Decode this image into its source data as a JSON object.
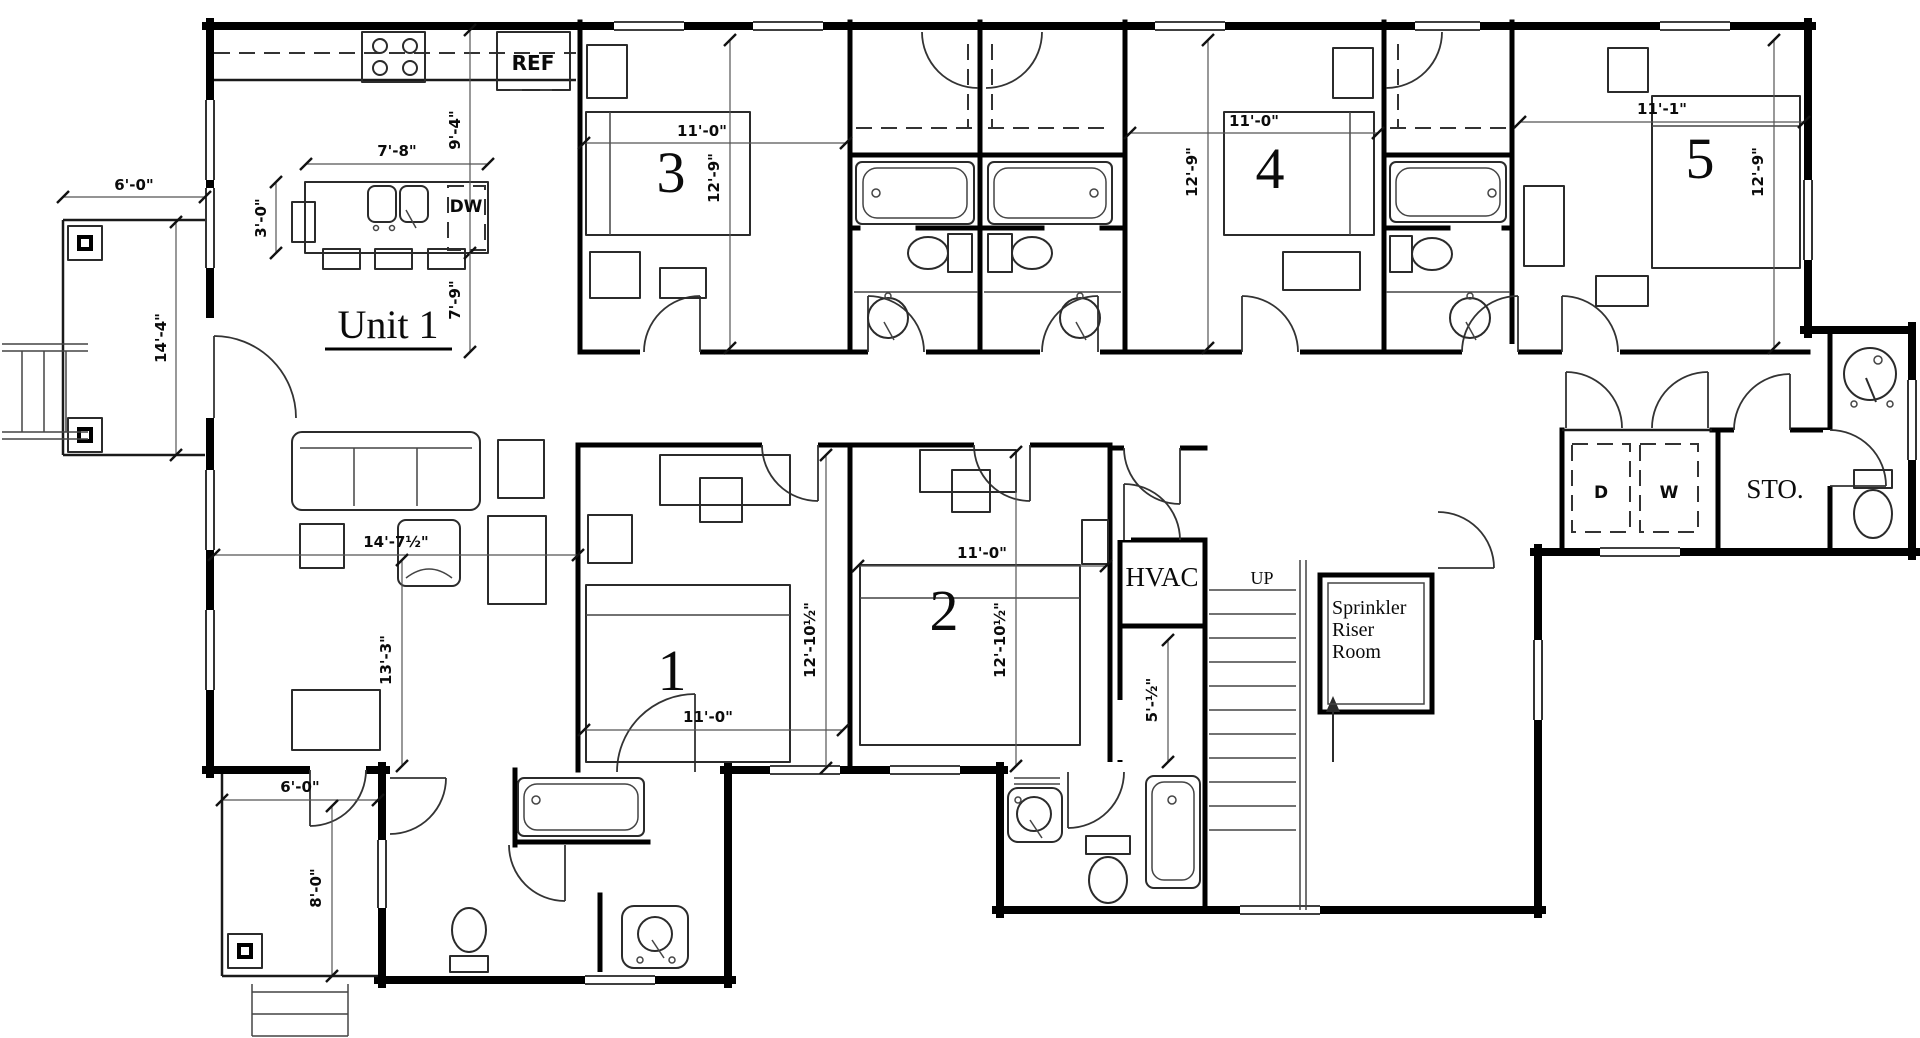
{
  "drawing": {
    "unit_label": "Unit 1",
    "numbers": {
      "bedroom1": "1",
      "bedroom2": "2",
      "bedroom3": "3",
      "bedroom4": "4",
      "bedroom5": "5"
    },
    "labels": {
      "refrigerator": "REF",
      "dishwasher": "DW",
      "hvac": "HVAC",
      "stair_up": "UP",
      "sprinkler_line1": "Sprinkler",
      "sprinkler_line2": "Riser",
      "sprinkler_line3": "Room",
      "dryer": "D",
      "washer": "W",
      "storage": "STO."
    },
    "dims": {
      "front_porch_width": "6'-0\"",
      "front_porch_depth": "14'-4\"",
      "island_width": "7'-8\"",
      "island_depth": "3'-0\"",
      "kitchen_depth": "9'-4\"",
      "kitchen_to_wall": "7'-9\"",
      "bedroom3_width": "11'-0\"",
      "bedroom3_depth": "12'-9\"",
      "bedroom4_width": "11'-0\"",
      "bedroom4_depth": "12'-9\"",
      "bedroom5_width": "11'-1\"",
      "bedroom5_depth": "12'-9\"",
      "living_width": "14'-7½\"",
      "living_depth": "13'-3\"",
      "bedroom1_width": "11'-0\"",
      "bedroom1_depth": "12'-10½\"",
      "bedroom2_width": "11'-0\"",
      "bedroom2_depth": "12'-10½\"",
      "closet_width": "5'-½\"",
      "rear_porch_width": "6'-0\"",
      "rear_porch_depth": "8'-0\""
    }
  }
}
